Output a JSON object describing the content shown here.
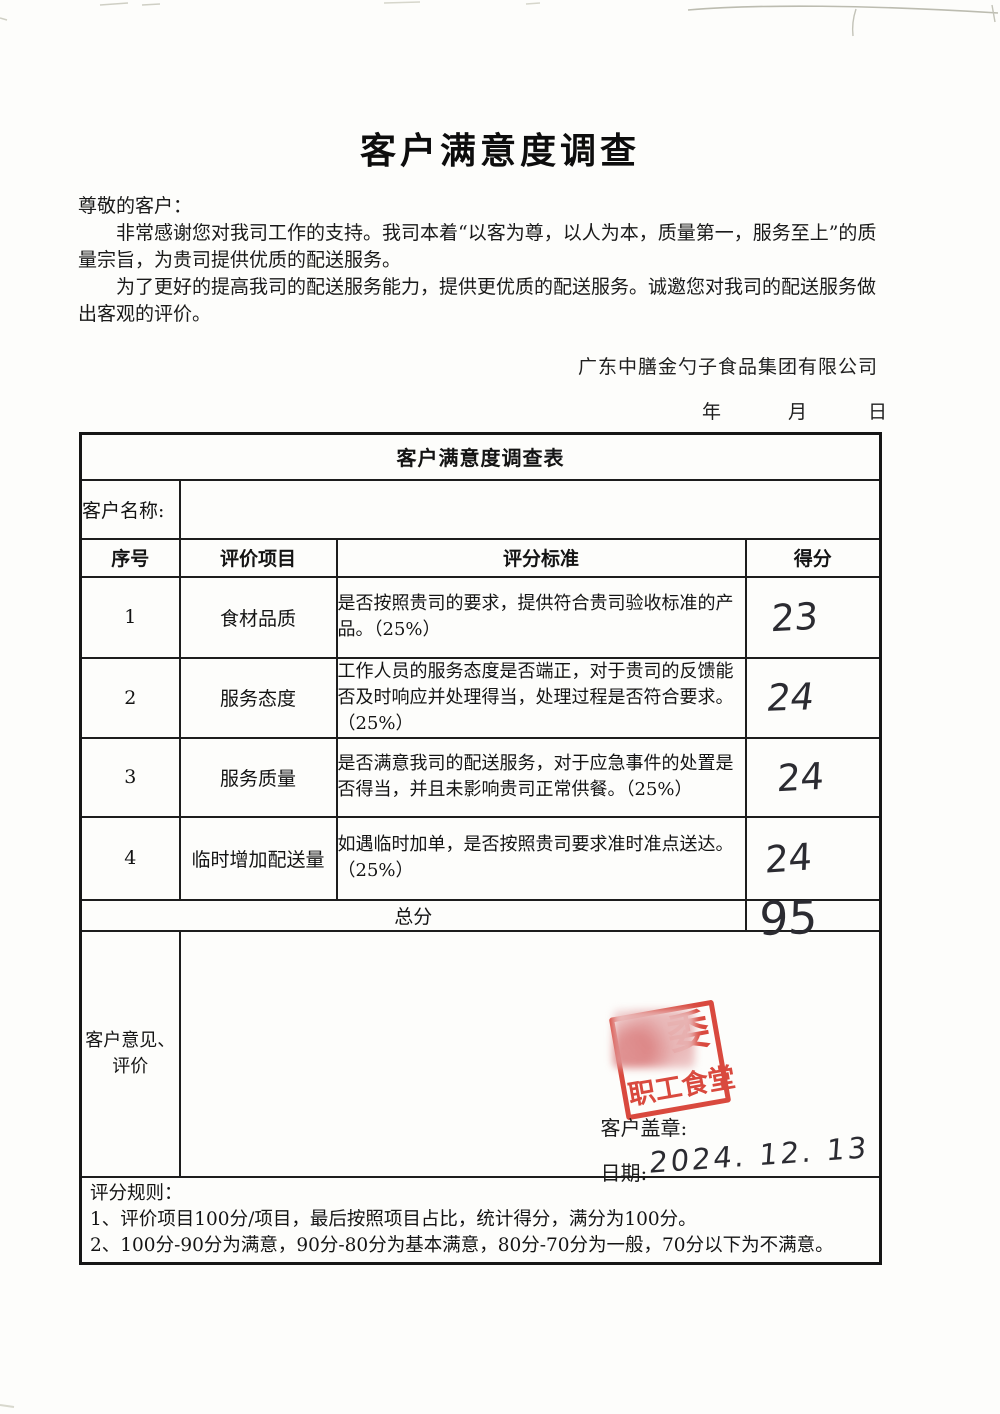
{
  "colors": {
    "stamp_red": "#d63a2e",
    "ink": "#2b2b31",
    "paper": "#fdfdfb"
  },
  "doc": {
    "title": "客户满意度调查",
    "salutation": "尊敬的客户：",
    "intro_p1": "非常感谢您对我司工作的支持。我司本着“以客为尊，以人为本，质量第一，服务至上”的质量宗旨，为贵司提供优质的配送服务。",
    "intro_p2": "为了更好的提高我司的配送服务能力，提供更优质的配送服务。诚邀您对我司的配送服务做出客观的评价。",
    "company": "广东中膳金勺子食品集团有限公司",
    "date_blanks": {
      "year": "年",
      "month": "月",
      "day": "日"
    }
  },
  "form": {
    "title": "客户满意度调查表",
    "customer_name_label": "客户名称:",
    "customer_name_value": "",
    "headers": [
      "序号",
      "评价项目",
      "评分标准",
      "得分"
    ],
    "rows": [
      {
        "no": "1",
        "item": "食材品质",
        "criteria": "是否按照贵司的要求，提供符合贵司验收标准的产品。（25%）",
        "score": "23"
      },
      {
        "no": "2",
        "item": "服务态度",
        "criteria": "工作人员的服务态度是否端正，对于贵司的反馈能否及时响应并处理得当，处理过程是否符合要求。（25%）",
        "score": "24"
      },
      {
        "no": "3",
        "item": "服务质量",
        "criteria": "是否满意我司的配送服务，对于应急事件的处置是否得当，并且未影响贵司正常供餐。（25%）",
        "score": "24"
      },
      {
        "no": "4",
        "item": "临时增加配送量",
        "criteria": "如遇临时加单，是否按照贵司要求准时准点送达。（25%）",
        "score": "24"
      }
    ],
    "total": {
      "label": "总分",
      "score": "95"
    },
    "comments": {
      "label_line1": "客户意见、",
      "label_line2": "评价"
    },
    "stamp": {
      "top_char": "委",
      "bottom_text": "职工食堂"
    },
    "stamp_caption": "客户盖章:",
    "date_label": "日期:",
    "date_value": "2024. 12. 13"
  },
  "rules": {
    "heading": "评分规则：",
    "items": [
      "1、评价项目100分/项目，最后按照项目占比，统计得分，满分为100分。",
      "2、100分-90分为满意，90分-80分为基本满意，80分-70分为一般，70分以下为不满意。"
    ]
  }
}
